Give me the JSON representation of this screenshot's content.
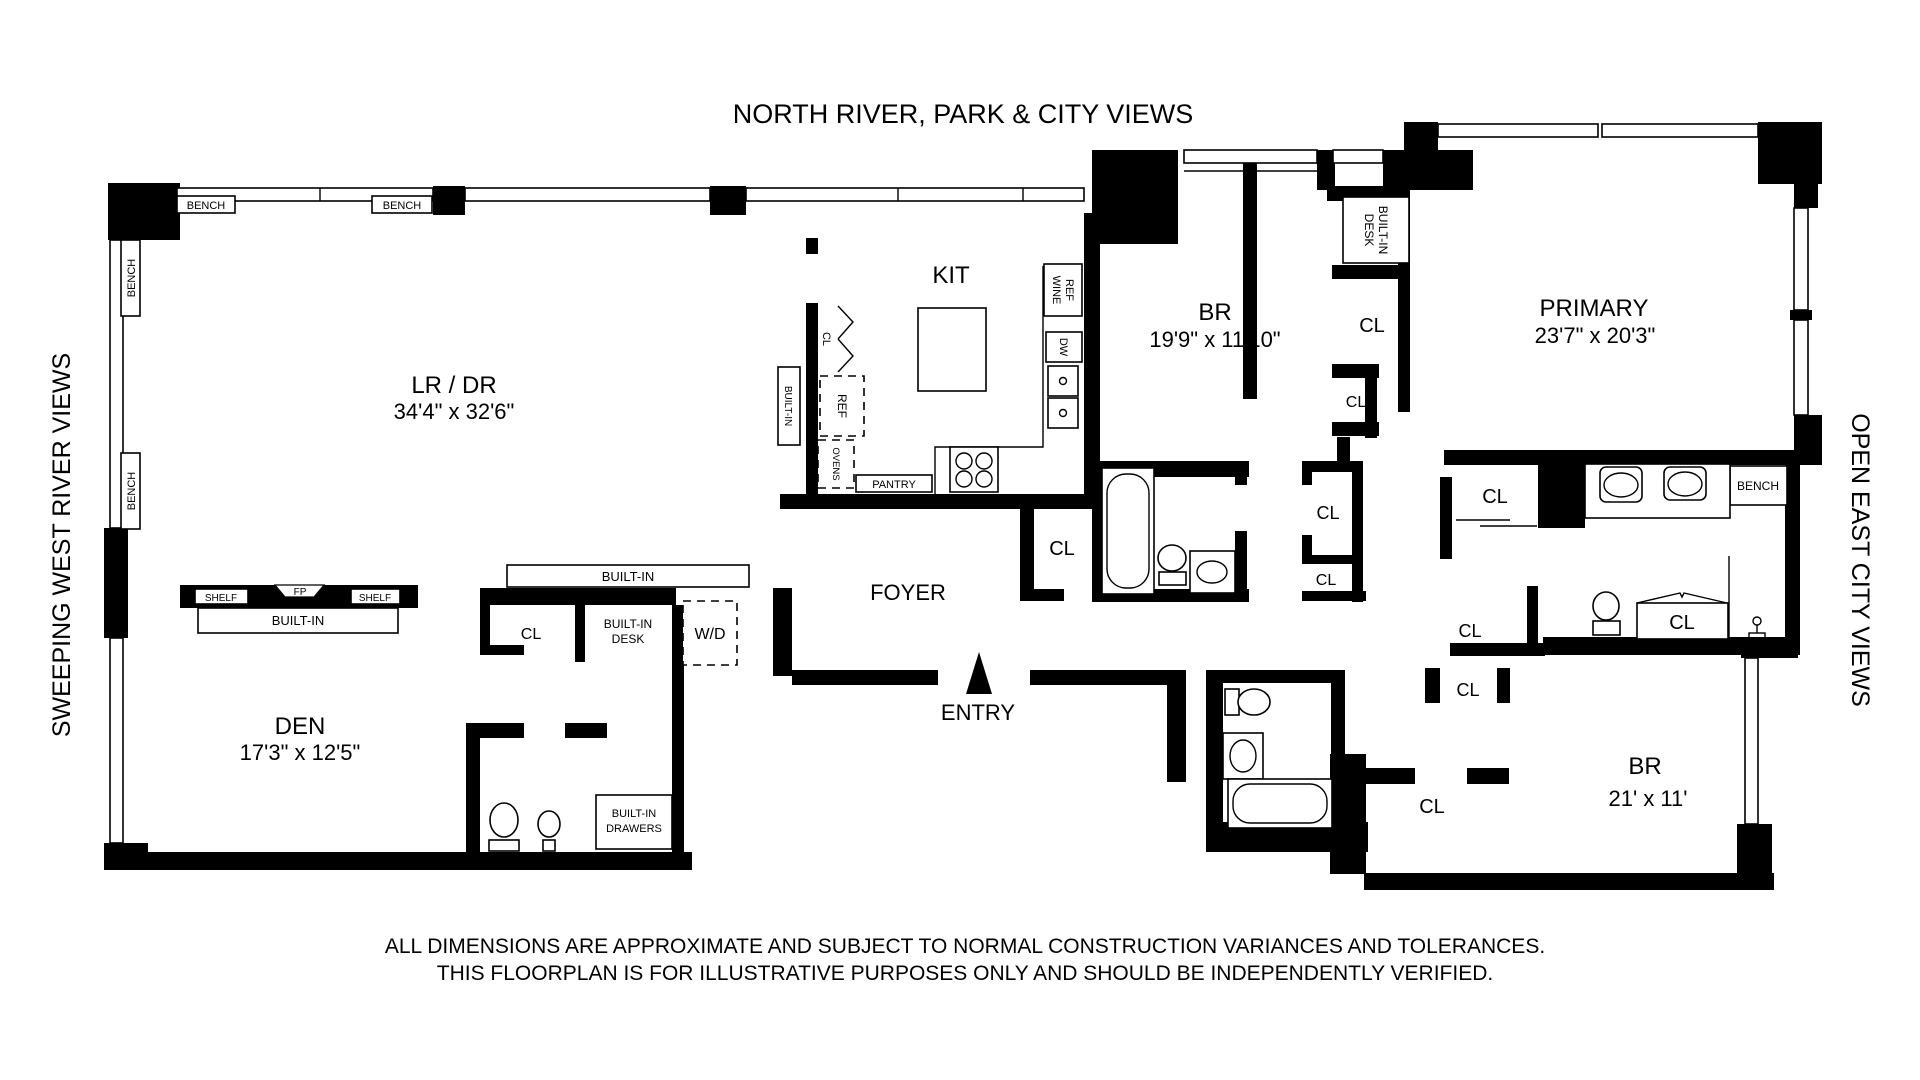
{
  "title": "NORTH RIVER, PARK & CITY VIEWS",
  "side_labels": {
    "left": "SWEEPING WEST RIVER VIEWS",
    "right": "OPEN EAST CITY VIEWS"
  },
  "rooms": {
    "lr_dr": {
      "name": "LR / DR",
      "dims": "34'4\" x 32'6\""
    },
    "kitchen": {
      "name": "KIT"
    },
    "bedroom_top": {
      "name": "BR",
      "dims": "19'9\" x 11'10\""
    },
    "primary": {
      "name": "PRIMARY",
      "dims": "23'7\" x 20'3\""
    },
    "den": {
      "name": "DEN",
      "dims": "17'3\" x 12'5\""
    },
    "bedroom_right": {
      "name": "BR",
      "dims": "21' x 11'"
    },
    "foyer": {
      "name": "FOYER"
    },
    "entry": {
      "name": "ENTRY"
    }
  },
  "labels": {
    "cl": "CL",
    "bench": "BENCH",
    "shelf": "SHELF",
    "fp": "FP",
    "built_in": "BUILT-IN",
    "desk": "DESK",
    "drawers": "DRAWERS",
    "wine": "WINE",
    "ref": "REF",
    "dw": "DW",
    "ovens": "OVENS",
    "pantry": "PANTRY",
    "wd": "W/D"
  },
  "disclaimer": {
    "line1": "ALL DIMENSIONS ARE APPROXIMATE AND SUBJECT TO NORMAL CONSTRUCTION VARIANCES AND TOLERANCES.",
    "line2": "THIS FLOORPLAN IS FOR ILLUSTRATIVE PURPOSES ONLY AND SHOULD BE INDEPENDENTLY VERIFIED."
  },
  "colors": {
    "wall": "#000000",
    "background": "#ffffff"
  }
}
